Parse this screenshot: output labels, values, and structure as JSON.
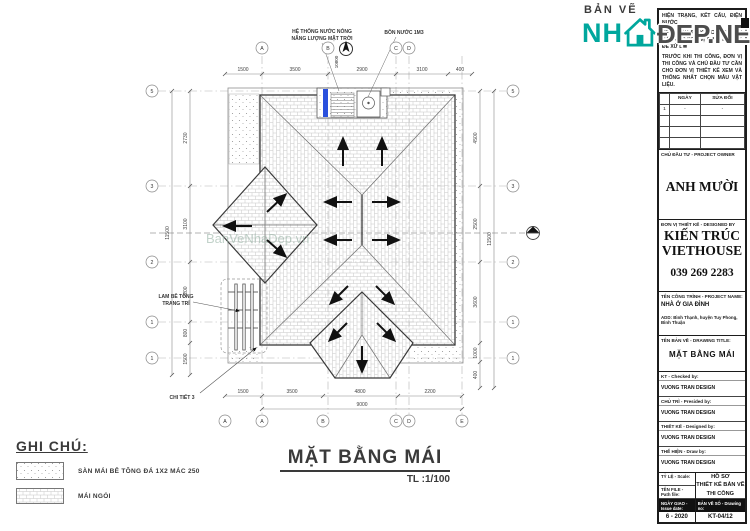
{
  "logo": {
    "prefix": "BẢN VẼ",
    "nh": "NH",
    "suffix": "ĐẸP.NET",
    "teal": "#00A79D"
  },
  "plan": {
    "title": "MẶT BẰNG MÁI",
    "scale": "TL :1/100",
    "watermark": "BanVeNhaDep.vn",
    "annotations": {
      "solar_line1": "HỆ THỐNG NƯỚC NÓNG",
      "solar_line2": "NĂNG LƯỢNG MẶT TRỜI",
      "tank": "BỒN NƯỚC 1M3",
      "level": "10800",
      "louver_line1": "LAM BÊ TÔNG",
      "louver_line2": "TRANG TRÍ",
      "detail": "CHI TIẾT 3"
    },
    "grid": {
      "top": [
        "A",
        "B",
        "C",
        "D"
      ],
      "bottom": [
        "A",
        "A",
        "B",
        "C",
        "D",
        "E"
      ],
      "left": [
        "5",
        "3",
        "2",
        "1",
        "1"
      ],
      "right": [
        "5",
        "3",
        "2",
        "1",
        "1"
      ]
    },
    "dims": {
      "top": [
        "1500",
        "3500",
        "2900",
        "3100",
        "400"
      ],
      "bottom": [
        "1500",
        "3500",
        "4800",
        "2200"
      ],
      "bottom_total": "9000",
      "left": [
        "2730",
        "3100",
        "2200",
        "800",
        "1500"
      ],
      "left_total": "11500",
      "right": [
        "4500",
        "2500",
        "3600",
        "1000",
        "400"
      ],
      "right_total": "11500"
    },
    "legend": {
      "heading": "GHI CHÚ:",
      "items": [
        {
          "label": "SÀN MÁI BÊ TÔNG ĐÁ 1X2 MÁC 250"
        },
        {
          "label": "MÁI NGÓI"
        }
      ]
    },
    "colors": {
      "solar_blue": "#2a50dd",
      "tile_line": "#c6c6c6"
    }
  },
  "title_block": {
    "notes": {
      "p1": "HIỆN TRẠNG, KẾT CẤU, ĐIỆN NƯỚC.",
      "p2": "NẾU THẤY SỰ KHÁC BIỆT PHẢI BÁO CHO ĐƠN VỊ THIẾT KẾ BIẾT ĐỂ XỬ LÝ.",
      "p3": "TRƯỚC KHI THI CÔNG, ĐƠN VỊ THI CÔNG VÀ CHỦ ĐẦU TƯ CẦN CHO ĐƠN VỊ THIẾT KẾ XEM VÀ THỐNG NHẤT CHỌN MẪU VẬT LIỆU."
    },
    "revision": {
      "col_date": "NGÀY",
      "col_change": "SỬA ĐỔI",
      "rows": [
        [
          "1",
          "-",
          "-"
        ],
        [
          "",
          "",
          ""
        ],
        [
          "",
          "",
          ""
        ],
        [
          "",
          "",
          ""
        ]
      ]
    },
    "owner": {
      "label": "CHỦ ĐẦU TƯ - PROJECT OWNER",
      "name": "ANH MƯỜI"
    },
    "designer": {
      "label": "ĐƠN VỊ THIẾT KẾ - DESIGNED BY",
      "name1": "KIẾN TRÚC",
      "name2": "VIETHOUSE",
      "phone": "039 269 2283"
    },
    "project": {
      "label": "TÊN CÔNG TRÌNH - PROJECT NAME:",
      "name": "NHÀ Ở GIA ĐÌNH",
      "address": "ADD: Bình Thạnh, huyện Tuy Phong, Bình Thuận"
    },
    "drawing_title": {
      "label": "TÊN BẢN VẼ - DRAWING TITLE:",
      "value": "MẶT BẰNG MÁI"
    },
    "personnel": [
      {
        "label": "KT - Checked by:",
        "value": "VUONG TRAN DESIGN"
      },
      {
        "label": "CHỦ TRÌ - Presided by:",
        "value": "VUONG TRAN DESIGN"
      },
      {
        "label": "THIẾT KẾ - Designed by:",
        "value": "VUONG TRAN DESIGN"
      },
      {
        "label": "THỂ HIỆN - Draw by:",
        "value": "VUONG TRAN DESIGN"
      }
    ],
    "footer": {
      "scale_label": "TỶ LỆ - Scale:",
      "file_label": "TÊN FILE - Path file:",
      "issue_label": "NGÀY GIAO - Issue date:",
      "issue_value": "6 - 2020",
      "doc_line1": "HỒ SƠ",
      "doc_line2": "THIẾT KẾ BẢN VẼ",
      "doc_line3": "THI CÔNG",
      "no_label": "BẢN VẼ SỐ - Drawing no:",
      "no_value": "KT-04/12"
    }
  }
}
